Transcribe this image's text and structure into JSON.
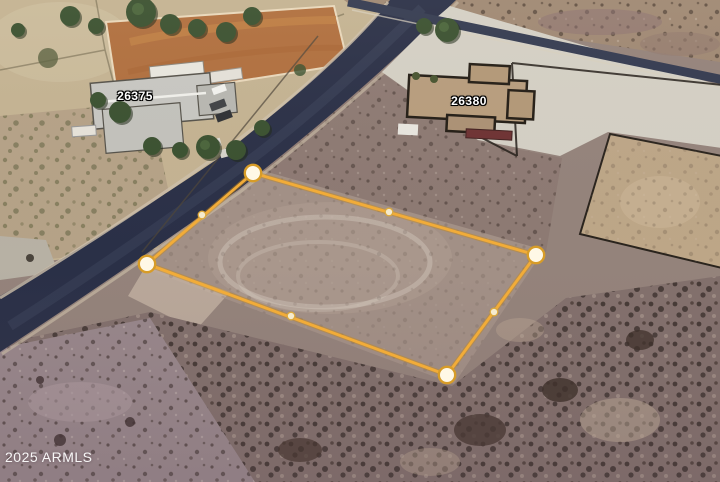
{
  "map": {
    "kind": "satellite-aerial-photo",
    "watermark": {
      "text": "2025 ARMLS",
      "style": "left:5px;top:449px"
    },
    "address_labels": [
      {
        "text": "26375",
        "style": "left:135px;top:96px"
      },
      {
        "text": "26380",
        "style": "left:469px;top:101px"
      }
    ],
    "parcel_overlay": {
      "outline_color": "#F2AC38",
      "outline_glow_color": "rgba(198,138,28,0.45)",
      "marker_fill": "#FFF8E6",
      "marker_ring_color": "#D79C28",
      "midpoint_fill": "#F5EBCE",
      "midpoint_ring_color": "#DCA93C",
      "points_attr": "253,173 536,255 447,375 147,264",
      "vertices": [
        {
          "x": 253,
          "y": 173
        },
        {
          "x": 536,
          "y": 255
        },
        {
          "x": 447,
          "y": 375
        },
        {
          "x": 147,
          "y": 264
        }
      ],
      "edge_midpoints": [
        {
          "x": 389,
          "y": 212
        },
        {
          "x": 494,
          "y": 312
        },
        {
          "x": 291,
          "y": 316
        },
        {
          "x": 202,
          "y": 215
        }
      ]
    }
  }
}
